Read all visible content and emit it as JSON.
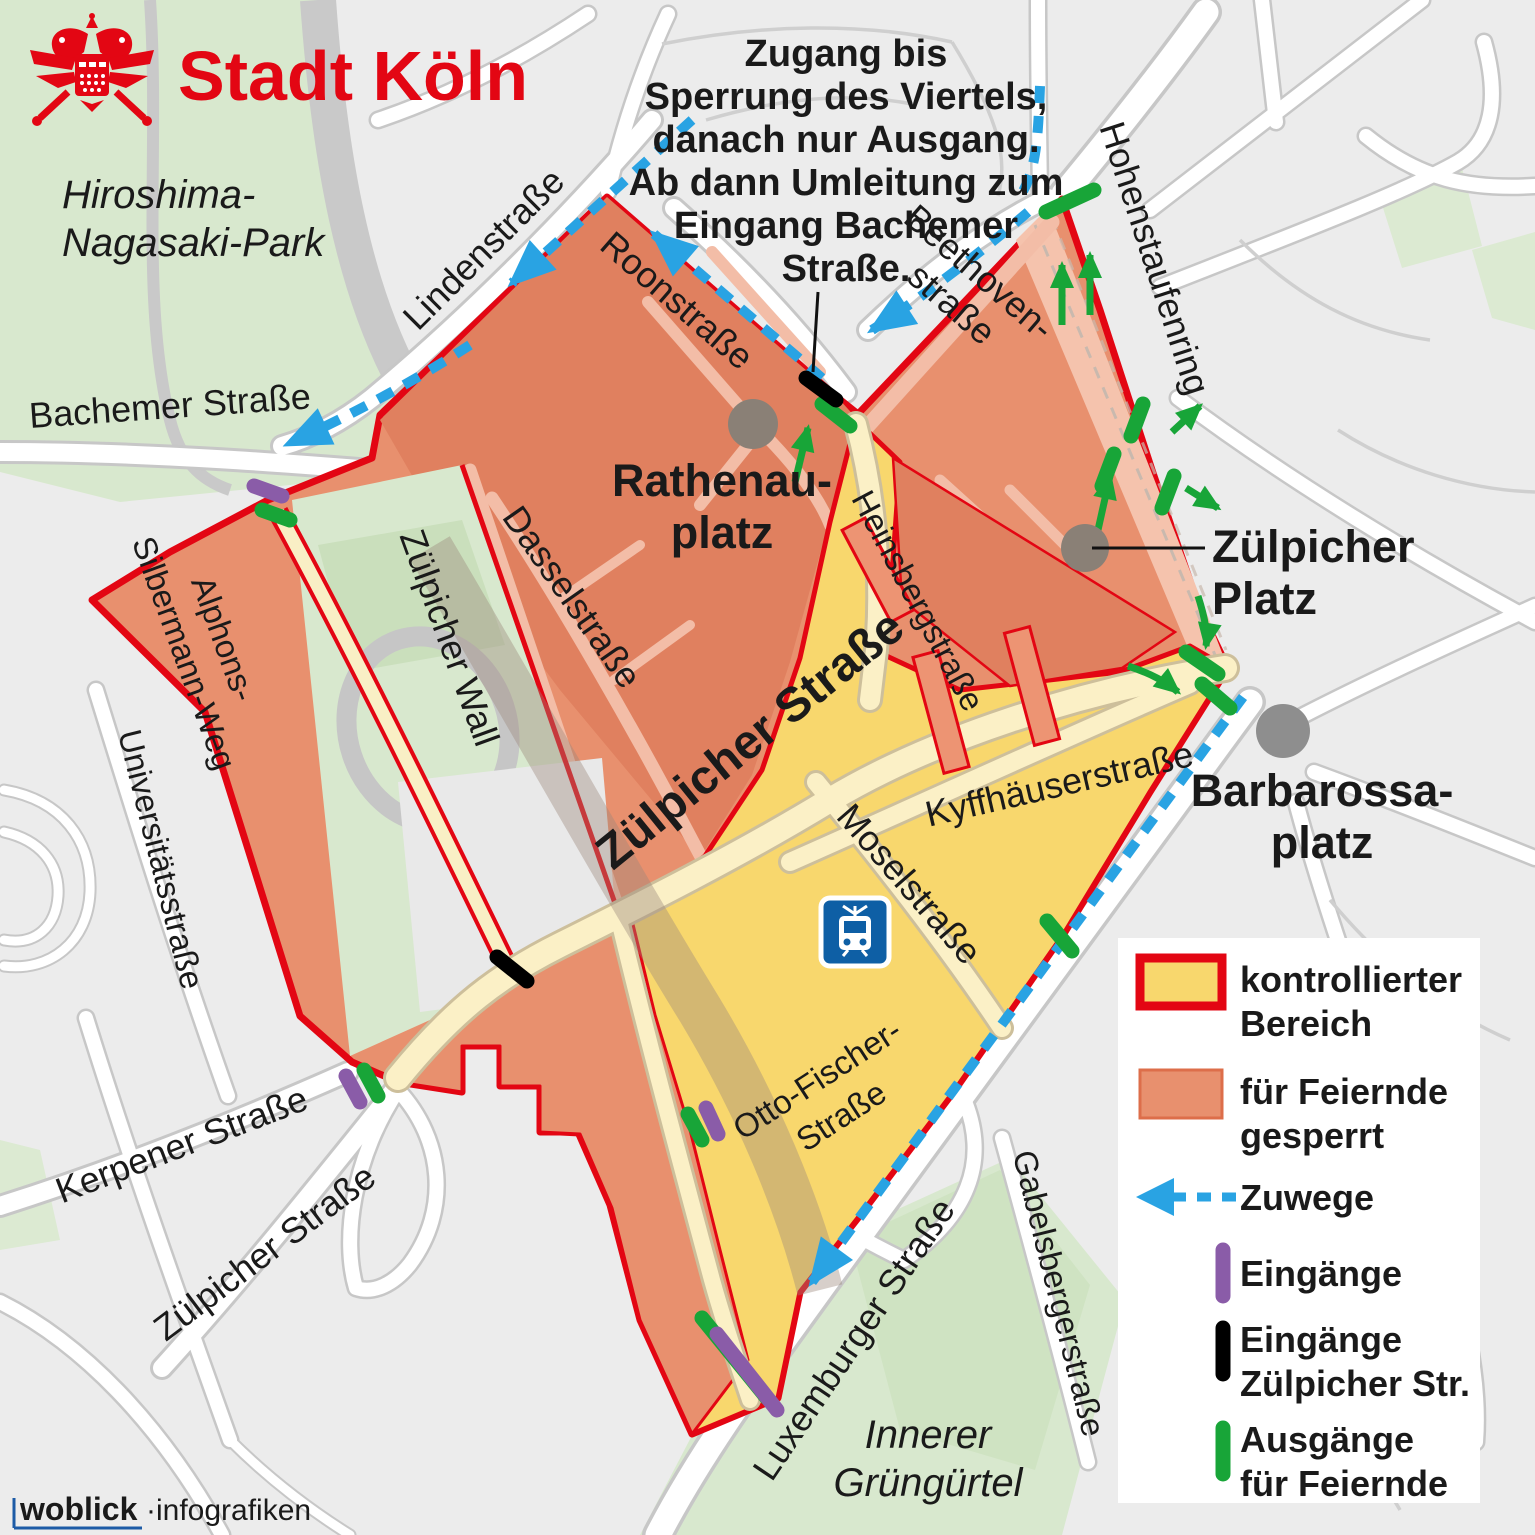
{
  "brand": {
    "name": "Stadt Köln"
  },
  "annotation": {
    "line1": "Zugang bis",
    "line2": "Sperrung des Viertels,",
    "line3": "danach nur Ausgang.",
    "line4": "Ab dann Umleitung zum",
    "line5": "Eingang Bachemer",
    "line6": "Straße."
  },
  "labels": {
    "park_hiroshima_1": "Hiroshima-",
    "park_hiroshima_2": "Nagasaki-Park",
    "park_gruenguertel_1": "Innerer",
    "park_gruenguertel_2": "Grüngürtel",
    "bachemer": "Bachemer Straße",
    "linden": "Lindenstraße",
    "roon": "Roonstraße",
    "beethoven_1": "Beethoven-",
    "beethoven_2": "straße",
    "hohenstaufenring": "Hohenstaufenring",
    "rathenau_1": "Rathenau-",
    "rathenau_2": "platz",
    "zuelpicher_platz_1": "Zülpicher",
    "zuelpicher_platz_2": "Platz",
    "barbarossa_1": "Barbarossa-",
    "barbarossa_2": "platz",
    "heinsberg": "Heinsbergstraße",
    "dassel": "Dasselstraße",
    "zuelpicher_haupt": "Zülpicher Straße",
    "kyffhaeuser": "Kyffhäuserstraße",
    "mosel": "Moselstraße",
    "alphons_1": "Alphons-",
    "alphons_2": "Silbermann-Weg",
    "zuelpicher_wall": "Zülpicher Wall",
    "universitaet": "Universitätsstraße",
    "kerpener": "Kerpener Straße",
    "zuelpicher_sw": "Zülpicher Straße",
    "otto_1": "Otto-Fischer-",
    "otto_2": "Straße",
    "luxemburger": "Luxemburger Straße",
    "gabelsberger": "Gabelsbergerstraße"
  },
  "legend": {
    "controlled_1": "kontrollierter",
    "controlled_2": "Bereich",
    "blocked_1": "für Feiernde",
    "blocked_2": "gesperrt",
    "zuwege": "Zuwege",
    "entrances": "Eingänge",
    "entrances_zuelpicher_1": "Eingänge",
    "entrances_zuelpicher_2": "Zülpicher Str.",
    "exits_1": "Ausgänge",
    "exits_2": "für Feiernde"
  },
  "footer": {
    "brand": "woblick",
    "suffix": "·infografiken"
  },
  "colors": {
    "accent_red": "#e30613",
    "zone_blocked_fill": "#e8906e",
    "zone_blocked_dark": "#e0805f",
    "zone_controlled_fill": "#f8d76d",
    "ring_strip": "#f5c3ad",
    "zuwege_blue": "#29a3e3",
    "entrance_purple": "#8a5ca8",
    "entrance_black": "#000000",
    "exit_green": "#18a538",
    "park_green": "#d8e8ce",
    "tram_blue": "#0e5fa5",
    "footer_blue": "#1d5ba6"
  }
}
